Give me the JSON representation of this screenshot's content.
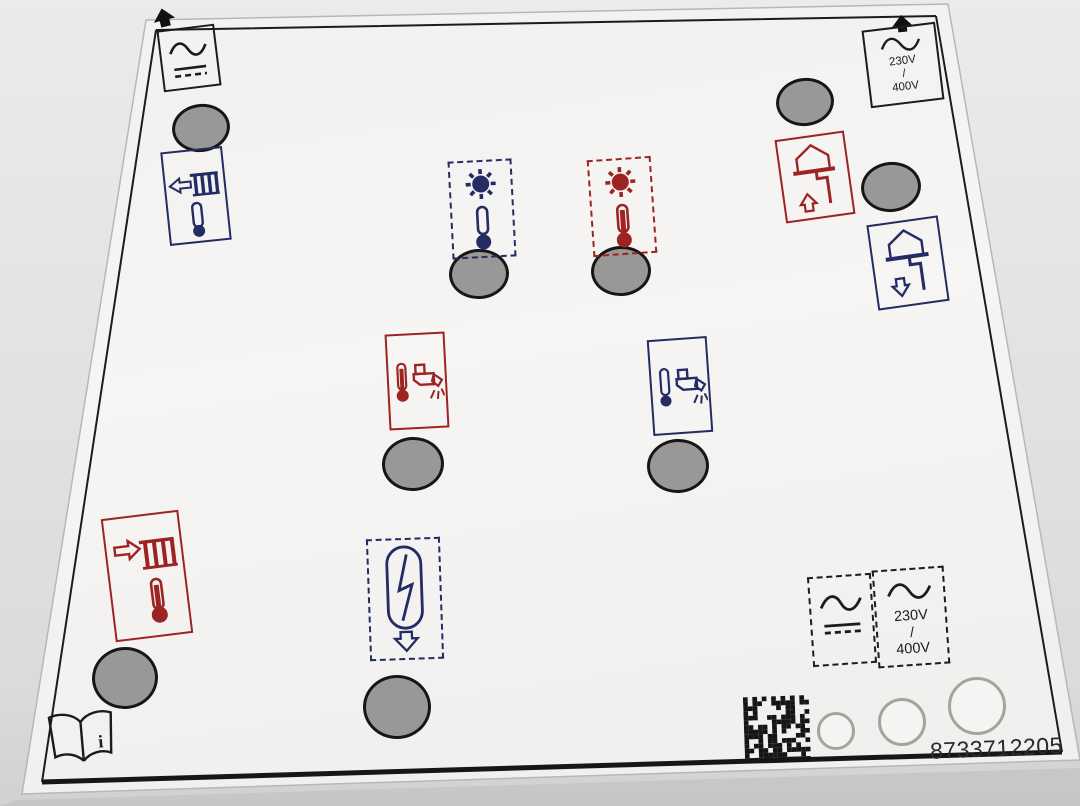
{
  "part_number": "8733712205",
  "voltage_top": {
    "v1": "230V",
    "sep": "/",
    "v2": "400V"
  },
  "voltage_bottom": {
    "v1": "230V",
    "sep": "/",
    "v2": "400V"
  },
  "book_info_mark": "i",
  "colors": {
    "red": "#9e2323",
    "blue": "#232c63",
    "black": "#1c1c1c",
    "hole_gray": "#989896",
    "hole_stroke": "#161616",
    "ring_gray": "#a3a3a0",
    "sheet": "#f5f4f2",
    "bg": "#e6e5e3",
    "text_dark": "#2b2b2b"
  },
  "icons": {
    "corner_arrow": "solid up arrow alignment marker",
    "ac_power": "sine wave over solid and dashed line (AC/DC supply)",
    "voltage_supply": "sine wave with 230V / 400V mains label",
    "radiator_return_cold": "blue radiator with outward arrow and thermometer",
    "radiator_flow_hot": "red radiator with inward arrow and thermometer",
    "solar_cold": "blue sun with thermometer (low temperature)",
    "solar_hot": "red sun with thermometer (high temperature)",
    "house_flow": "red house with pipe and up arrow (heating flow)",
    "house_return": "blue house with pipe and down arrow (heating return)",
    "hot_water_tap": "red thermometer with running tap (domestic hot water)",
    "cold_water_tap": "blue thermometer with running tap (cold water)",
    "compressor": "capsule with zigzag and down arrow (heat pump compressor)",
    "manual_book": "open manual book with info mark",
    "datamatrix": "2D data matrix code",
    "drill_hole": "grey filled knock-out circle",
    "punch_ring": "grey outlined punch ring"
  }
}
